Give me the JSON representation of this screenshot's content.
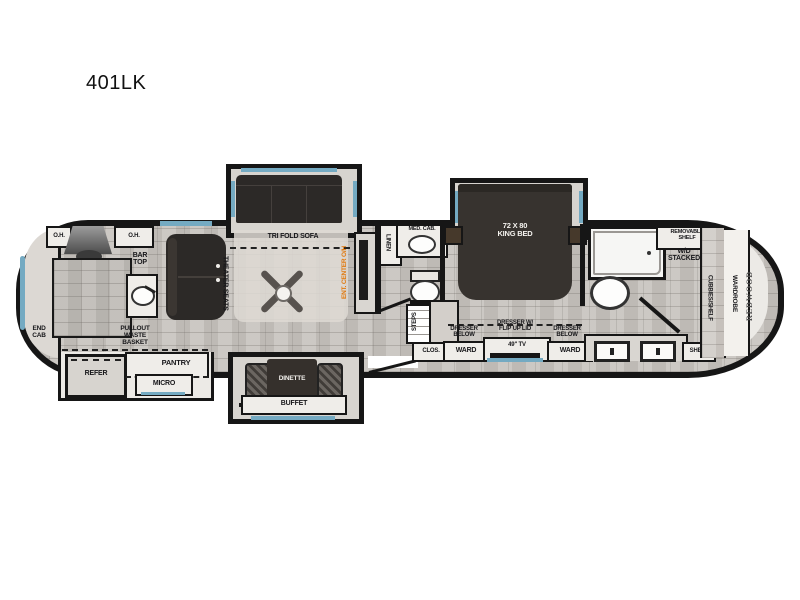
{
  "title": "401LK",
  "colors": {
    "wall": "#161616",
    "floor": "#c8c4bf",
    "window_accent": "#74aac2",
    "furniture_dark": "#2c2927",
    "ent_center_text": "#e0790f",
    "logo_text": "#4e4e4e"
  },
  "labels": {
    "oh_left": "O.H.",
    "oh_right": "O.H.",
    "bar_top": "BAR\nTOP",
    "end_cab": "END\nCAB",
    "pullout_waste": "PULLOUT\nWASTE\nBASKET",
    "refer": "REFER",
    "pantry": "PANTRY",
    "micro": "MICRO",
    "theater_seats": "THEATER SEATS",
    "trifold_sofa": "TRI FOLD SOFA",
    "ent_center": "ENT. CENTER O/H",
    "dinette": "DINETTE",
    "buffet": "BUFFET",
    "linen": "LINEN",
    "med_cab": "MED. CAB.",
    "steps": "STEPS",
    "clos": "CLOS.",
    "king_bed": "72 X 80\nKING BED",
    "dresser_left": "DRESSER\nBELOW",
    "ward_left": "WARD",
    "dresser_center": "DRESSER W/\nFLIP UP LID",
    "tv49": "49\" TV",
    "dresser_right": "DRESSER\nBELOW",
    "ward_right": "WARD",
    "removable_shelf": "REMOVABLE\nSHELF",
    "wd_stacked": "W/D\nSTACKED",
    "shelf": "SHELF",
    "cubbies": "CUBBIES/SHELF",
    "wardrobe": "WARDROBE",
    "brand_logo": "REDWOOD"
  }
}
